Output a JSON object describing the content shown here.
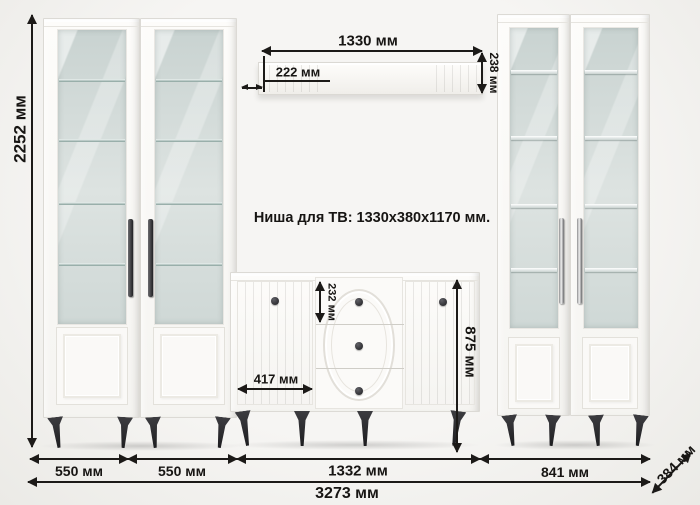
{
  "note": {
    "tv_niche": "Ниша для ТВ: 1330x380x1170 мм."
  },
  "dimensions": {
    "total_height": "2252 мм",
    "niche_width_top": "1330 мм",
    "shelf_inset": "222 мм",
    "top_shelf_height": "238 мм",
    "top_drawer_height": "232 мм",
    "chest_door_width": "417 мм",
    "chest_height": "875 мм",
    "left_cabinet_1_width": "550 мм",
    "left_cabinet_2_width": "550 мм",
    "center_section_width": "1332 мм",
    "right_section_width": "841 мм",
    "total_width": "3273 мм",
    "depth": "384 мм"
  },
  "colors": {
    "dimension_ink": "#1c1a18",
    "furniture_white": "#faf9f7",
    "glass": "#ccd5d3",
    "legs": "#2b2b2e",
    "background": "#f2f1ee"
  }
}
